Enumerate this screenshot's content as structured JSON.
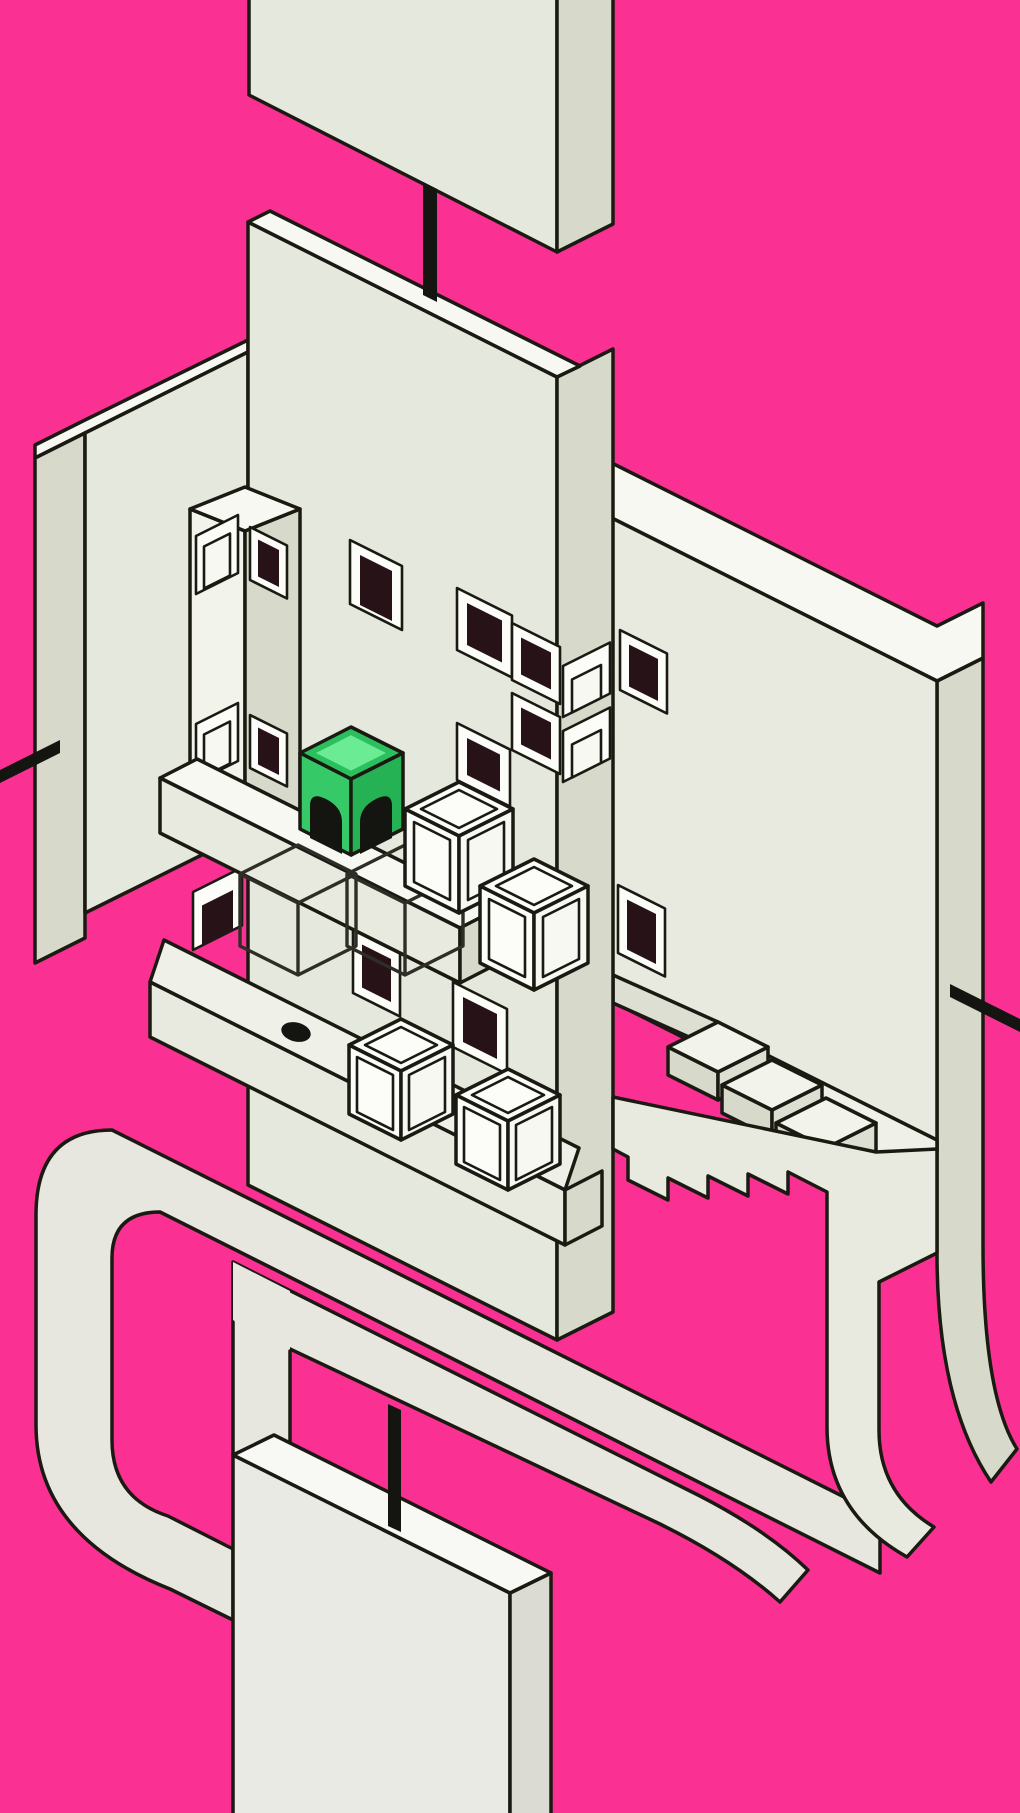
{
  "colors": {
    "pink": "#FA3193",
    "outline": "#1A1A12",
    "slabFront": "#E5E8DC",
    "slabSide": "#D7DACB",
    "slabTop": "#F7F8F2",
    "wallFront": "#E8EADF",
    "floorTop": "#EFF1E8",
    "tread": "#F2F3EB",
    "riser": "#DCDFD2",
    "pipe": "#E7E7E0",
    "pipeShade": "#DDDDD4",
    "darkWindow": "#261217",
    "frameWhite": "#FCFCF9",
    "greenFrame": "#2CBF5E",
    "greenTop": "#6BEB94",
    "greenLeft": "#35CA67",
    "greenRight": "#25B254",
    "black": "#141410",
    "bottomFront": "#EAEAE4",
    "bottomSide": "#DBDBD3",
    "bottomTop": "#F8F8F4"
  },
  "scene": {
    "style": "isometric impossible-architecture puzzle level",
    "background": "solid hot pink void",
    "objects": [
      {
        "name": "top-floating-slab",
        "type": "slab",
        "position": "top center, cut by top edge"
      },
      {
        "name": "top-connector-peg",
        "type": "black peg",
        "joins": "top slab to main wall slab"
      },
      {
        "name": "main-wall-slab",
        "type": "tall slab",
        "dark_windows": 7,
        "light_windows": 2
      },
      {
        "name": "left-wall-slab",
        "type": "slab",
        "dark_windows": 1
      },
      {
        "name": "left-connector-peg",
        "type": "black peg",
        "direction": "points left off wall"
      },
      {
        "name": "right-wall-slab",
        "type": "slab",
        "dark_windows": 2
      },
      {
        "name": "right-connector-peg",
        "type": "black peg",
        "direction": "points right off wall"
      },
      {
        "name": "window-pillar",
        "type": "square column",
        "light_windows": 2,
        "dark_windows": 2
      },
      {
        "name": "upper-ledge",
        "type": "beam",
        "holds": "green cube and white cube"
      },
      {
        "name": "green-character-cube",
        "type": "cube",
        "color": "green",
        "faces": "black arched doorways"
      },
      {
        "name": "ghost-cube-outline-1",
        "type": "wireframe cube slot"
      },
      {
        "name": "ghost-cube-outline-2",
        "type": "wireframe cube slot"
      },
      {
        "name": "white-cube-1",
        "type": "framed white cube"
      },
      {
        "name": "white-cube-2",
        "type": "framed white cube"
      },
      {
        "name": "white-cube-3",
        "type": "framed white cube"
      },
      {
        "name": "white-cube-4",
        "type": "framed white cube"
      },
      {
        "name": "hole-ledge",
        "type": "beam",
        "detail": "black oval socket on top"
      },
      {
        "name": "upper-staircase",
        "steps": 3,
        "descends": "to the right"
      },
      {
        "name": "lower-staircase",
        "steps": 4,
        "style": "sawtooth bottom edge"
      },
      {
        "name": "pipe-loop",
        "type": "flat looping track",
        "corners": "rounded, weaves behind slabs"
      },
      {
        "name": "pipe-j-hook",
        "type": "triple rail curve, bottom right"
      },
      {
        "name": "bottom-slab",
        "type": "slab",
        "position": "bottom, cut by lower edge"
      },
      {
        "name": "bottom-connector-peg",
        "type": "black peg",
        "joins": "pipe bar to bottom slab"
      }
    ]
  }
}
